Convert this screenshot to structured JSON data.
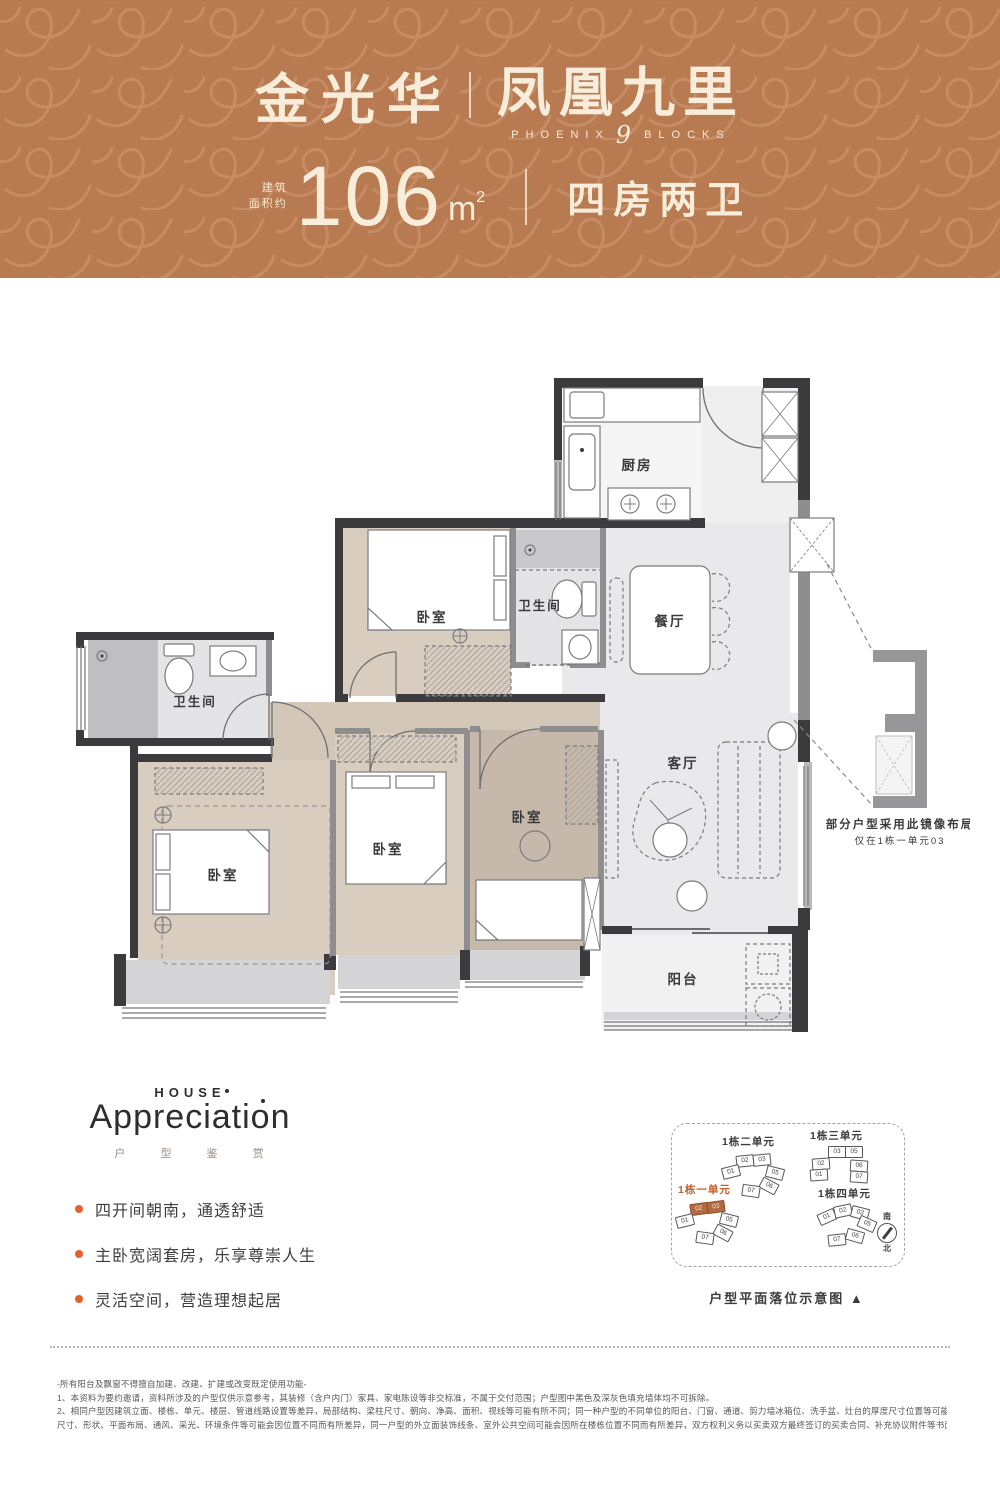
{
  "colors": {
    "header_bg": "#b87a50",
    "header_pattern": "#c9916a",
    "header_text": "#f7edda",
    "accent_orange": "#e2612c",
    "highlight_copper": "#b26a43",
    "wall_dark": "#3b3b3d",
    "wall_gray": "#8e8e91",
    "floor_gray": "#e9e9eb",
    "floor_wood": "#d7ccbd"
  },
  "header": {
    "brand_left": "金光华",
    "brand_right": "凤凰九里",
    "brand_sub_left": "PHOENIX",
    "brand_sub_nine": "9",
    "brand_sub_right": "BLOCKS",
    "area_prefix_line1": "建筑",
    "area_prefix_line2": "面积约",
    "area_value": "106",
    "area_unit": "m",
    "area_unit_sup": "2",
    "type_label": "四房两卫"
  },
  "floorplan": {
    "rooms": {
      "kitchen": "厨房",
      "dining": "餐厅",
      "bathroom": "卫生间",
      "bedroom": "卧室",
      "living": "客厅",
      "balcony": "阳台"
    },
    "mirror_note": {
      "line1": "部分户型采用此镜像布局",
      "line2": "仅在1栋一单元03"
    }
  },
  "appreciation": {
    "eyebrow": "HOUSE",
    "title": "Appreciation",
    "subtitle": "户 型 鉴 赏",
    "bullets": [
      "四开间朝南，通透舒适",
      "主卧宽阔套房，乐享尊崇人生",
      "灵活空间，营造理想起居"
    ]
  },
  "siteplan": {
    "clusters": [
      {
        "name": "1栋二单元",
        "units": [
          "02",
          "03",
          "01",
          "05",
          "06",
          "07"
        ]
      },
      {
        "name": "1栋三单元",
        "units": [
          "03",
          "05",
          "02",
          "01",
          "06",
          "07"
        ]
      },
      {
        "name": "1栋一单元",
        "units": [
          "02",
          "03",
          "01",
          "05",
          "06",
          "07"
        ]
      },
      {
        "name": "1栋四单元",
        "units": [
          "01",
          "02",
          "03",
          "05",
          "06",
          "07"
        ]
      }
    ],
    "compass": {
      "south": "南",
      "north": "北"
    },
    "caption": "户型平面落位示意图 ▲"
  },
  "disclaimer": {
    "lines": [
      "-所有阳台及飘窗不得擅自加建、改建、扩建或改变既定使用功能-",
      "1、本资料为要约邀请，资料所涉及的户型仅供示意参考，其装修（含户内门）家具、家电陈设等非交标准，不属于交付范围；户型图中黑色及深灰色填充墙体均不可拆除。",
      "2、相同户型因建筑立面、楼栋、单元、楼层、管道线路设置等差异，局部结构、梁柱尺寸、朝向、净高、面积、视线等可能有所不同；同一种户型的不同单位的阳台、门窗、通道、剪力墙冰箱位、洗手盆、灶台的厚度尺寸位置等可能不同，每一单位的结构面积、",
      "尺寸、形状、平面布局、通风、采光、环境条件等可能会因位置不同而有所差异，同一户型的外立面装饰线条、室外公共空间可能会因所在楼栋位置不同而有所差异，双方权利义务以买卖双方最终签订的买卖合同、补充协议附件等书面文件及实际交付为准。"
    ]
  }
}
